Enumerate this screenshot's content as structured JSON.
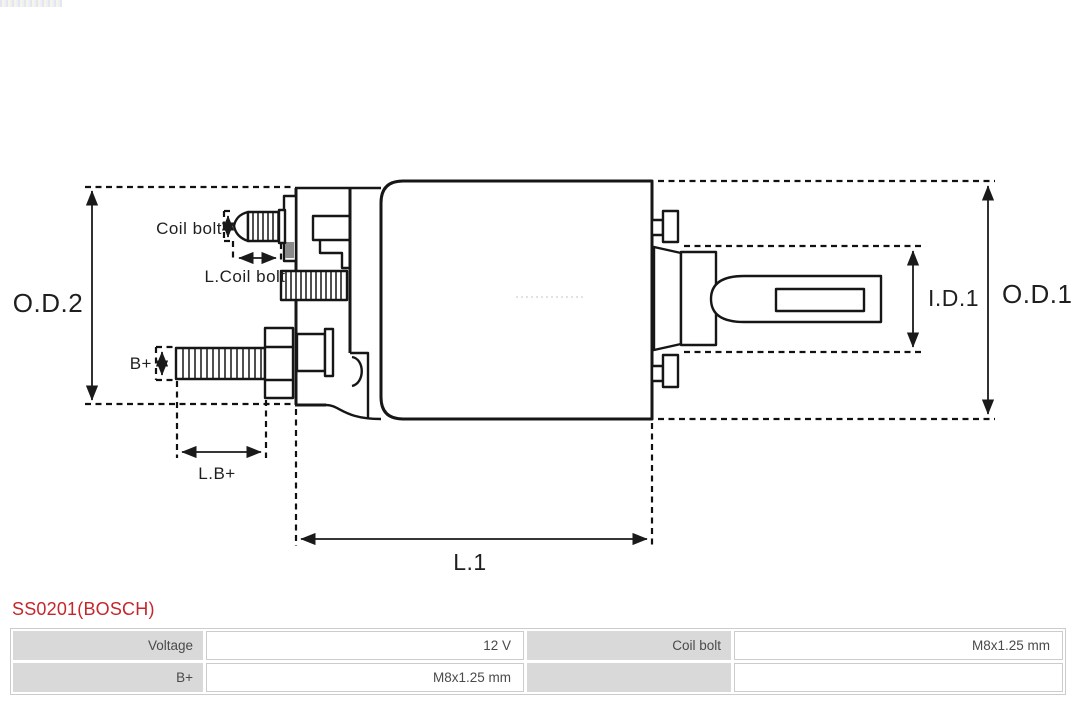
{
  "page": {
    "background": "#ffffff",
    "line_color": "#161616",
    "accent_red": "#c5262c",
    "table_label_bg": "#d9d9d9",
    "table_border": "#cccccc",
    "table_text": "#4a4a4a"
  },
  "header": {
    "logo_remnant": "partial-logo-strip"
  },
  "diagram": {
    "type": "starter-solenoid-dimension-drawing",
    "labels": {
      "od2": "O.D.2",
      "od1": "O.D.1",
      "id1": "I.D.1",
      "l1": "L.1",
      "coil_bolt": "Coil bolt",
      "l_coil_bolt": "L.Coil bolt",
      "b_plus": "B+",
      "l_b_plus": "L.B+"
    }
  },
  "product": {
    "title": "SS0201(BOSCH)"
  },
  "spec_table": {
    "rows": [
      [
        {
          "label": "Voltage",
          "value": "12 V"
        },
        {
          "label": "Coil bolt",
          "value": "M8x1.25 mm"
        }
      ],
      [
        {
          "label": "B+",
          "value": "M8x1.25 mm"
        },
        {
          "label": "",
          "value": ""
        }
      ]
    ]
  }
}
